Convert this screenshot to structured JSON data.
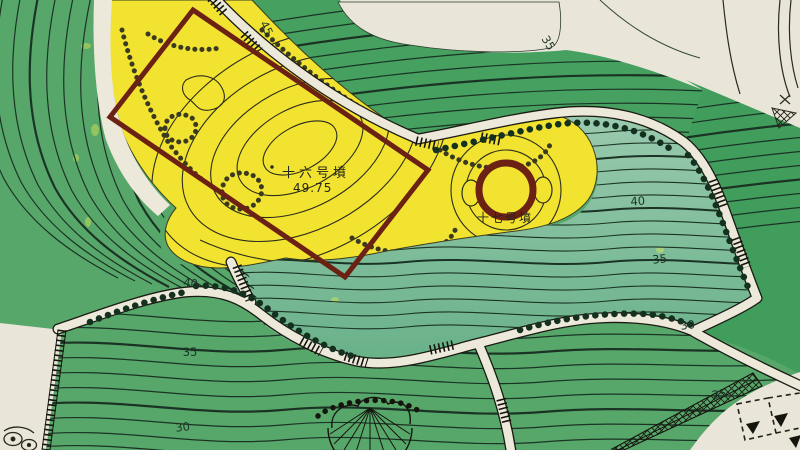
{
  "map": {
    "labels": {
      "tomb16": "十六号墳",
      "tomb16_elevation": "49.75",
      "tomb17": "十七号墳"
    },
    "contour_labels": [
      {
        "id": "c45-top",
        "value": "45"
      },
      {
        "id": "c35-topright",
        "value": "35"
      },
      {
        "id": "c40-left",
        "value": "40"
      },
      {
        "id": "c35-left",
        "value": "35"
      },
      {
        "id": "c30-left",
        "value": "30"
      },
      {
        "id": "c40-right",
        "value": "40"
      },
      {
        "id": "c35-right",
        "value": "35"
      },
      {
        "id": "c30-right",
        "value": "30"
      },
      {
        "id": "c25-bottomright",
        "value": "25"
      }
    ],
    "colors": {
      "paper": "#e9e5d8",
      "path-cream": "#ece8da",
      "green-left": "#57a76a",
      "green-band": "#46a060",
      "green-bottom": "#4ea465",
      "green-wedge": "#419d5b",
      "teal-top": "#9acaaf",
      "teal-bottom": "#68b189",
      "yellow": "#f1e32f",
      "maroon": "#6b2113",
      "contour": "#1b3325"
    }
  }
}
